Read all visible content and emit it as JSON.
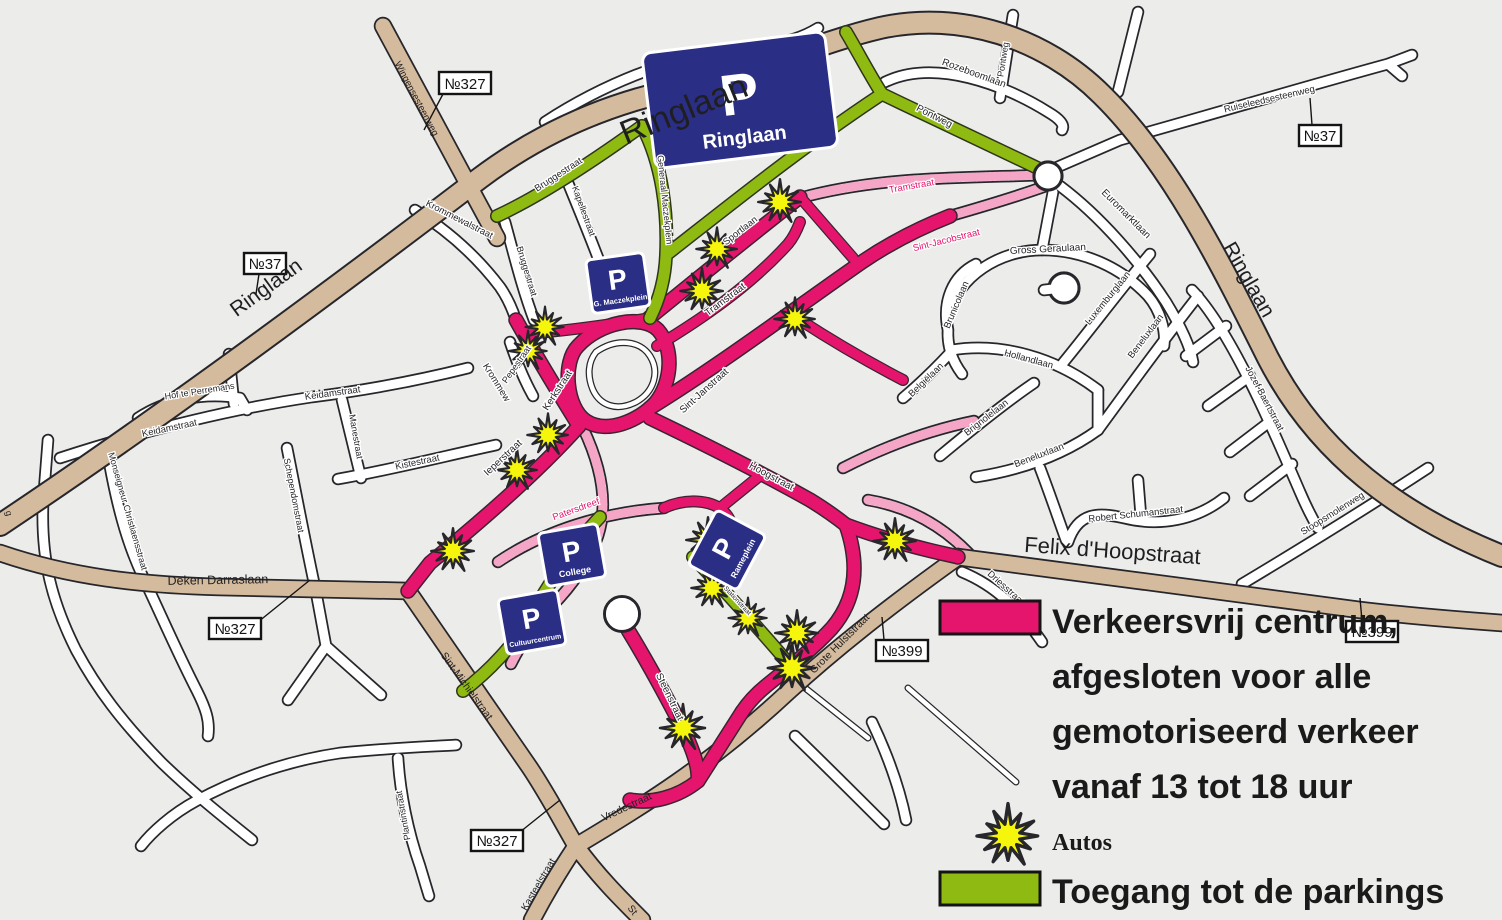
{
  "legend": {
    "line1": "Verkeersvrij centrum,",
    "line2": "afgesloten voor alle",
    "line3": "gemotoriseerd verkeer",
    "line4": "vanaf 13 tot 18 uur",
    "autos": "Autos",
    "parkings": "Toegang tot de parkings",
    "pedestrian_color": "#E5156D",
    "parking_access_color": "#8FBA12",
    "autos_star_color": "#F6F60D"
  },
  "colors": {
    "background": "#ECEDEA",
    "major_road": "#D5BB9E",
    "minor_road": "#FFFFFF",
    "pedestrian_zone": "#E5156D",
    "parking_access": "#8FBA12",
    "parking_sign": "#2A2E85"
  },
  "parking": {
    "p": "P",
    "ringlaan": "Ringlaan",
    "maczekplein": "G. Maczekplein",
    "college": "College",
    "cultuurcentrum": "Cultuurcentrum",
    "rameplein": "Rameplein"
  },
  "badges": {
    "n327": "№327",
    "n37": "№37",
    "n399": "№399"
  },
  "streets": {
    "ringlaan": "Ringlaan",
    "wingensesteenweg": "Wingensesteenweg",
    "bruggestraat": "Bruggestraat",
    "kapellestraat": "Kapellestraat",
    "krommewalstraat": "Krommewalstraat",
    "krommew": "Krommew",
    "generaal_maczekplein": "Generaal Maczekplein",
    "sportlaan": "Sportlaan",
    "pontweg": "Pontweg",
    "rozeboomlaan": "Rozeboomlaan",
    "ruiseleedsesteenweg": "Ruiseleedsesteenweg",
    "euromarktlaan": "Euromarktlaan",
    "gross_geraulaan": "Gross Geraulaan",
    "brunicolaan": "Brunicolaan",
    "luxemburglaan": "Luxemburglaan",
    "hollandlaan": "Hollandlaan",
    "beneluxlaan": "Beneluxlaan",
    "belgielaan": "Belgiëlaan",
    "brignolelaan": "Brignolelaan",
    "jozef_baertstraat": "Jozef Baertstraat",
    "robert_schumanstraat": "Robert Schumanstraat",
    "stoopsmolenweg": "Stoopsmolenweg",
    "driesstraat": "Driesstraat",
    "felix_dhoopstraat": "Felix d'Hoopstraat",
    "grote_hulststraat": "Grote Hulststraat",
    "tramstraat": "Tramstraat",
    "sint_jacobstraat": "Sint-Jacobstraat",
    "sint_janstraat": "Sint-Janstraat",
    "kerkstraat": "Kerkstraat",
    "ieperstraat": "Ieperstraat",
    "hoogstraat": "Hoogstraat",
    "steenstraat": "Steenstraat",
    "patersdreef": "Patersdreef",
    "stationstraat": "Stationstraat",
    "pepestraat": "Pepestraat",
    "hof_te_perremans": "Hof te Perremans",
    "keidamstraat": "Keidamstraat",
    "manestraat": "Manestraat",
    "kistestraat": "Kistestraat",
    "schependomstraat": "Schependomstraat",
    "monseigneur_christiaensstraat": "Monseigneur Christiaensstraat",
    "deken_darraslaan": "Deken Darraslaan",
    "plantinstraat": "Plantinstraat",
    "sint_michielstraat": "Sint-Michielstraat",
    "vredestraat": "Vredestraat",
    "kasteelstraat": "Kasteelstraat",
    "st_partial": "St",
    "g_partial": "g"
  }
}
